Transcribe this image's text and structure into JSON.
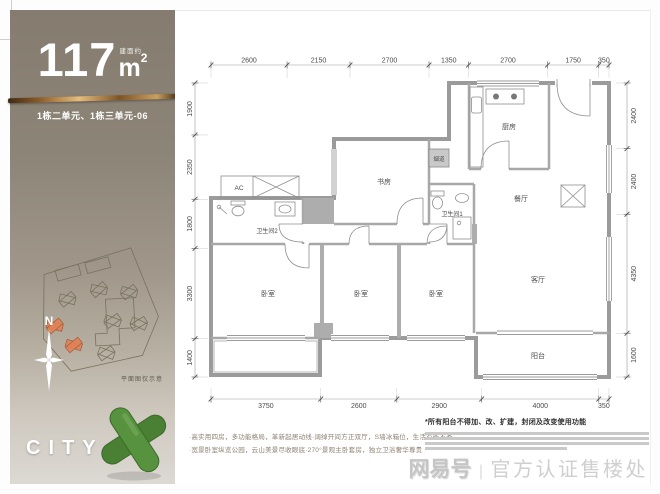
{
  "sidebar": {
    "area_value": "117",
    "area_prefix": "建面约",
    "area_unit": "m",
    "area_sup": "2",
    "unit_line": "1栋二单元、1栋三单元-06",
    "siteplan_caption": "平面图仅示意",
    "compass_label": "N",
    "brand": "CITY",
    "accent_gold": "#c99a5b",
    "bg_top": "#857c6f",
    "bg_bottom": "#dcd9d3",
    "sculpture_green": "#57923e"
  },
  "floorplan": {
    "rooms": [
      {
        "label": "厨房",
        "x": 328,
        "y": 78,
        "s": 7
      },
      {
        "label": "餐厅",
        "x": 340,
        "y": 150,
        "s": 7
      },
      {
        "label": "书房",
        "x": 203,
        "y": 133,
        "s": 7
      },
      {
        "label": "卫生间1",
        "x": 271,
        "y": 165,
        "s": 6
      },
      {
        "label": "卫生间2",
        "x": 86,
        "y": 182,
        "s": 6
      },
      {
        "label": "烟道",
        "x": 258,
        "y": 110,
        "s": 5.5
      },
      {
        "label": "AC",
        "x": 58,
        "y": 139,
        "s": 6.5
      },
      {
        "label": "卧室",
        "x": 87,
        "y": 245,
        "s": 7
      },
      {
        "label": "卧室",
        "x": 180,
        "y": 245,
        "s": 7
      },
      {
        "label": "卧室",
        "x": 255,
        "y": 245,
        "s": 7
      },
      {
        "label": "客厅",
        "x": 357,
        "y": 231,
        "s": 7
      },
      {
        "label": "阳台",
        "x": 357,
        "y": 307,
        "s": 7
      }
    ],
    "dimensions": {
      "top": {
        "segs": [
          2600,
          2150,
          2700,
          1350,
          2700,
          1750,
          350
        ],
        "from": 30,
        "to": 428,
        "line": 14
      },
      "bottom": {
        "segs": [
          3750,
          2600,
          2900,
          4000,
          350
        ],
        "from": 30,
        "to": 428,
        "line": 348
      },
      "left": {
        "segs": [
          1900,
          2350,
          1800,
          3300,
          1400
        ],
        "from": 32,
        "to": 326,
        "line": 14
      },
      "right": {
        "segs": [
          2400,
          2400,
          4350,
          1600
        ],
        "from": 32,
        "to": 326,
        "line": 446
      }
    }
  },
  "footer": {
    "bullet1": "·高实用四房，多功能格局，革新起居动线·阔绰开间方正双厅，S墙冰箱位，生活有条不紊",
    "bullet2": "·宽景卧室纵览公园，云山美景尽收眼底·270°景观主卧套房，独立卫浴奢华尊贵",
    "note": "*所有阳台不得加、改、扩建，封闭及改变使用功能",
    "watermark_logo": "网易号",
    "watermark_sep": "|",
    "watermark_text": "官方认证售楼处"
  }
}
